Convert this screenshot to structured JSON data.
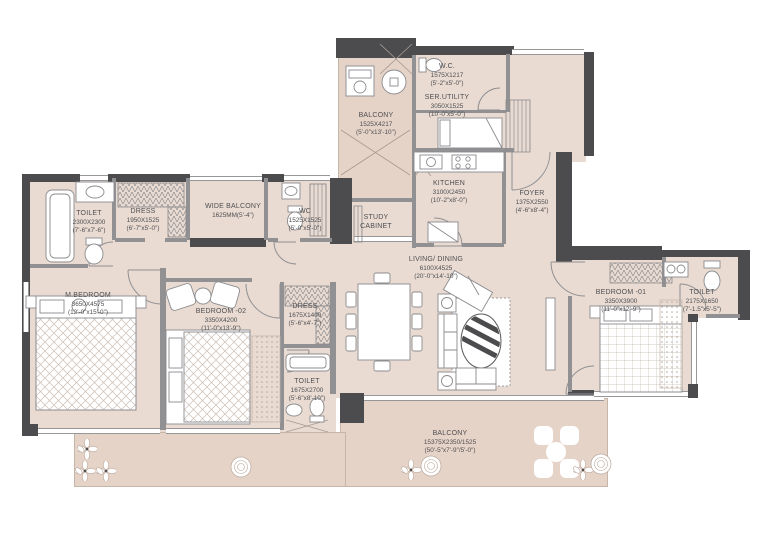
{
  "drawing_type": "apartment-floor-plan",
  "colors": {
    "floor": "#e9dbd2",
    "balcony_floor": "#e6d3c8",
    "wall_dark": "#4c4c4e",
    "wall_light": "#919194",
    "furniture_outline": "#8b8b8e",
    "text": "#4f4f52",
    "background": "#ffffff"
  },
  "rooms": {
    "wc_top": {
      "name": "W.C.",
      "dim_mm": "1575X1217",
      "dim_ft": "(5'-2\"x5'-0\")"
    },
    "ser_utility": {
      "name": "SER.UTILITY",
      "dim_mm": "3050X1525",
      "dim_ft": "(10'-0\"x5'-0\")"
    },
    "balcony_side": {
      "name": "BALCONY",
      "dim_mm": "1525X4217",
      "dim_ft": "(5'-0\"x13'-10\")"
    },
    "kitchen": {
      "name": "KITCHEN",
      "dim_mm": "3100X2450",
      "dim_ft": "(10'-2\"x8'-0\")"
    },
    "foyer": {
      "name": "FOYER",
      "dim_mm": "1375X2550",
      "dim_ft": "(4'-6\"x8'-4\")"
    },
    "toilet_master": {
      "name": "TOILET",
      "dim_mm": "2300X2300",
      "dim_ft": "(7'-6\"x7'-6\")"
    },
    "dress_master": {
      "name": "DRESS",
      "dim_mm": "1950X1525",
      "dim_ft": "(6'-7\"x5'-0\")"
    },
    "wide_balcony": {
      "name": "WIDE BALCONY",
      "dim_mm": "1625MM(5'-4\")"
    },
    "wc_small": {
      "name": "WC",
      "dim_mm": "1525X1525",
      "dim_ft": "(5'-0\"x5'-0\")"
    },
    "study": {
      "name": "STUDY",
      "name2": "CABINET"
    },
    "living": {
      "name": "LIVING/ DINING",
      "dim_mm": "6100X4525",
      "dim_ft": "(20'-0\"x14'-10\")"
    },
    "m_bedroom": {
      "name": "M.BEDROOM",
      "dim_mm": "3650X4575",
      "dim_ft": "(12'-0\"x15'-0\")"
    },
    "bedroom_02": {
      "name": "BEDROOM -02",
      "dim_mm": "3350X4200",
      "dim_ft": "(11'-0\"x13'-9\")"
    },
    "dress_02": {
      "name": "DRESS",
      "dim_mm": "1675X1400",
      "dim_ft": "(5'-6\"x4'-7\")"
    },
    "toilet_02": {
      "name": "TOILET",
      "dim_mm": "1675X2700",
      "dim_ft": "(5'-6\"x8'-10\")"
    },
    "bedroom_01": {
      "name": "BEDROOM -01",
      "dim_mm": "3350X3900",
      "dim_ft": "(11'-0\"x12'-9\")"
    },
    "toilet_01": {
      "name": "TOILET",
      "dim_mm": "2175X1650",
      "dim_ft": "(7'-1.5\"x5'-5\")"
    },
    "balcony_main": {
      "name": "BALCONY",
      "dim_mm": "15375X2350/1525",
      "dim_ft": "(50'-5\"x7'-9\"/5'-0\")"
    }
  }
}
